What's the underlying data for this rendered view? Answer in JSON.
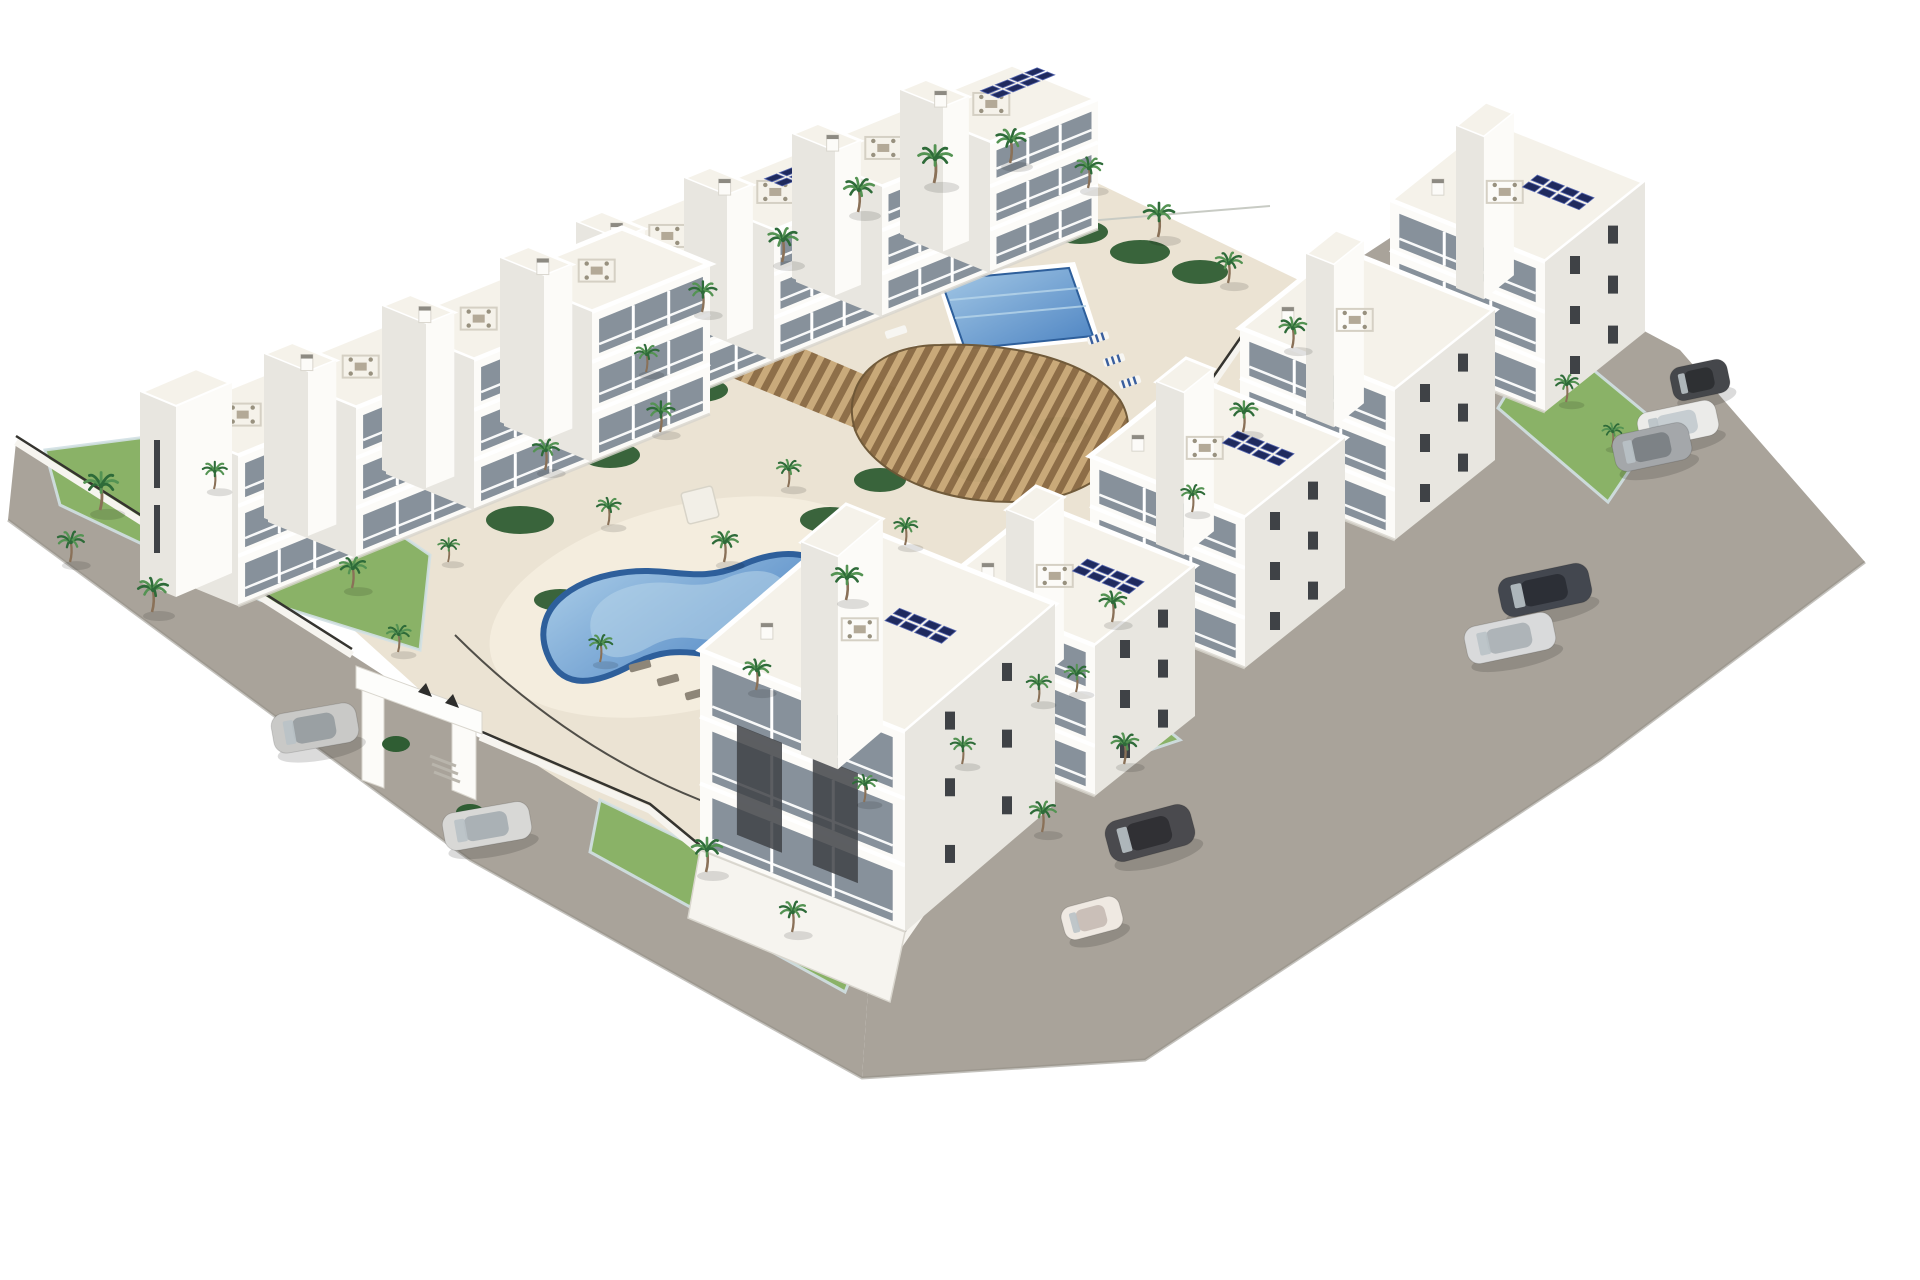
{
  "scene": {
    "type": "architectural-aerial-render",
    "subject": "white-apartment-complex-with-pools-palms-and-roads",
    "colors": {
      "background": "#ffffff",
      "road": "#a9a39a",
      "road_edge": "#948f87",
      "deck": "#ebe3d3",
      "deck_light": "#f4edde",
      "grass": "#8ab267",
      "grass_dark": "#558244",
      "shrub": "#2f5d33",
      "palm_green": "#2e6b39",
      "palm_green_light": "#549353",
      "palm_trunk": "#8a7158",
      "building_front": "#fcfbf8",
      "building_side": "#e8e6e0",
      "building_shade": "#d9d6ce",
      "roof": "#f5f2ea",
      "parapet": "#ffffff",
      "recess": "#6e6b64",
      "glass": "#87919b",
      "window_dark": "#3f4246",
      "railing": "#ffffff",
      "pool_rim": "#2e5f9b",
      "pool_water": "#5e92cb",
      "pool_water_light": "#b8d6ea",
      "solar": "#1f2a5e",
      "solar_line": "#5566b0",
      "pergola_wood": "#ab8a5c",
      "pergola_wood_dark": "#6e5736",
      "fence_dark": "#35342f",
      "glass_fence": "#d2e0e4",
      "wall_white": "#f6f4ef",
      "gate_mark": "#2e2e2c",
      "shadow": "#d8d5cd",
      "furniture": "#b3a997",
      "lounger_white": "#f7f6f2",
      "lounger_stripe": "#3a5f9e",
      "lounger_dark": "#8e8678"
    },
    "rows": {
      "nw_back": {
        "anchors": [
          [
            580,
            240
          ],
          [
            688,
            196
          ],
          [
            796,
            152
          ],
          [
            904,
            108
          ]
        ],
        "u": [
          108,
          -44
        ],
        "v": [
          86,
          35
        ],
        "h": 130,
        "solar": [
          1,
          3
        ]
      },
      "nw_front": {
        "anchors": [
          [
            150,
            420
          ],
          [
            268,
            372
          ],
          [
            386,
            324
          ],
          [
            504,
            276
          ]
        ],
        "u": [
          118,
          -48
        ],
        "v": [
          88,
          36
        ],
        "h": 150,
        "solar": []
      },
      "east": {
        "anchors": [
          [
            1390,
            200
          ],
          [
            1240,
            328
          ],
          [
            1090,
            456
          ],
          [
            940,
            584
          ]
        ],
        "s1": [
          155,
          62
        ],
        "s2": [
          100,
          -80
        ],
        "h": 150,
        "solar": [
          0,
          2,
          3
        ]
      },
      "corner": {
        "anchor": [
          700,
          650
        ],
        "s1": [
          205,
          82
        ],
        "s2": [
          150,
          -128
        ],
        "h": 200
      }
    },
    "palms": [
      [
        100,
        510,
        1.1
      ],
      [
        70,
        562,
        0.9
      ],
      [
        152,
        612,
        1.0
      ],
      [
        214,
        489,
        0.8
      ],
      [
        352,
        588,
        0.9
      ],
      [
        398,
        652,
        0.8
      ],
      [
        448,
        562,
        0.7
      ],
      [
        545,
        470,
        0.9
      ],
      [
        608,
        525,
        0.8
      ],
      [
        660,
        432,
        0.9
      ],
      [
        724,
        562,
        0.9
      ],
      [
        788,
        487,
        0.8
      ],
      [
        846,
        600,
        1.0
      ],
      [
        905,
        545,
        0.8
      ],
      [
        646,
        372,
        0.8
      ],
      [
        702,
        312,
        0.9
      ],
      [
        782,
        262,
        1.0
      ],
      [
        858,
        212,
        1.0
      ],
      [
        934,
        183,
        1.1
      ],
      [
        1010,
        163,
        1.0
      ],
      [
        1088,
        188,
        0.9
      ],
      [
        1158,
        237,
        1.0
      ],
      [
        1228,
        283,
        0.9
      ],
      [
        1292,
        348,
        0.9
      ],
      [
        1243,
        432,
        0.9
      ],
      [
        1192,
        512,
        0.8
      ],
      [
        1112,
        622,
        0.9
      ],
      [
        1038,
        702,
        0.8
      ],
      [
        1566,
        402,
        0.8
      ],
      [
        1612,
        447,
        0.7
      ],
      [
        706,
        872,
        1.0
      ],
      [
        792,
        932,
        0.9
      ],
      [
        864,
        802,
        0.8
      ],
      [
        962,
        764,
        0.8
      ],
      [
        1042,
        832,
        0.9
      ],
      [
        1124,
        764,
        0.9
      ],
      [
        1076,
        692,
        0.8
      ],
      [
        600,
        662,
        0.8
      ],
      [
        756,
        690,
        0.9
      ]
    ],
    "shrubs": [
      [
        520,
        520,
        34,
        14
      ],
      [
        610,
        455,
        30,
        13
      ],
      [
        700,
        390,
        28,
        12
      ],
      [
        770,
        345,
        26,
        11
      ],
      [
        905,
        255,
        30,
        12
      ],
      [
        960,
        235,
        28,
        12
      ],
      [
        1020,
        222,
        30,
        12
      ],
      [
        1080,
        232,
        28,
        12
      ],
      [
        1140,
        252,
        30,
        12
      ],
      [
        1200,
        272,
        28,
        12
      ],
      [
        660,
        610,
        30,
        13
      ],
      [
        740,
        640,
        34,
        14
      ],
      [
        560,
        600,
        26,
        11
      ],
      [
        830,
        520,
        30,
        13
      ],
      [
        880,
        480,
        26,
        12
      ],
      [
        1060,
        430,
        30,
        13
      ],
      [
        980,
        470,
        26,
        12
      ]
    ],
    "cars": [
      {
        "x": 315,
        "y": 728,
        "r": -10,
        "l": 86,
        "w": 40,
        "body": "#c9c9c7",
        "top": "#9aa0a3"
      },
      {
        "x": 487,
        "y": 826,
        "r": -10,
        "l": 88,
        "w": 38,
        "body": "#d8d8d6",
        "top": "#aab1b5"
      },
      {
        "x": 1700,
        "y": 380,
        "r": -12,
        "l": 58,
        "w": 34,
        "body": "#45474b",
        "top": "#2e3033"
      },
      {
        "x": 1678,
        "y": 424,
        "r": -12,
        "l": 80,
        "w": 36,
        "body": "#ebebe9",
        "top": "#c6cdd1"
      },
      {
        "x": 1652,
        "y": 447,
        "r": -12,
        "l": 78,
        "w": 38,
        "body": "#a4a7aa",
        "top": "#7d8286"
      },
      {
        "x": 1545,
        "y": 590,
        "r": -12,
        "l": 92,
        "w": 40,
        "body": "#43474f",
        "top": "#2c2f36"
      },
      {
        "x": 1510,
        "y": 638,
        "r": -12,
        "l": 90,
        "w": 38,
        "body": "#d9dadb",
        "top": "#aeb4b8"
      },
      {
        "x": 1150,
        "y": 833,
        "r": -15,
        "l": 88,
        "w": 42,
        "body": "#4a4a4e",
        "top": "#303034"
      },
      {
        "x": 1092,
        "y": 918,
        "r": -15,
        "l": 60,
        "w": 34,
        "body": "#efe9e2",
        "top": "#cabfb8"
      }
    ],
    "loungers_white": [
      [
        872,
        292
      ],
      [
        884,
        312
      ],
      [
        896,
        332
      ],
      [
        908,
        352
      ],
      [
        938,
        372
      ]
    ],
    "loungers_striped": [
      [
        1098,
        338
      ],
      [
        1114,
        360
      ],
      [
        1130,
        382
      ]
    ],
    "loungers_dark": [
      [
        640,
        666
      ],
      [
        668,
        680
      ],
      [
        696,
        694
      ]
    ],
    "gate": {
      "marks": 2
    },
    "counts": {
      "pools": 2,
      "buildings_rows": 3,
      "cars": 9,
      "palms": 39
    }
  }
}
